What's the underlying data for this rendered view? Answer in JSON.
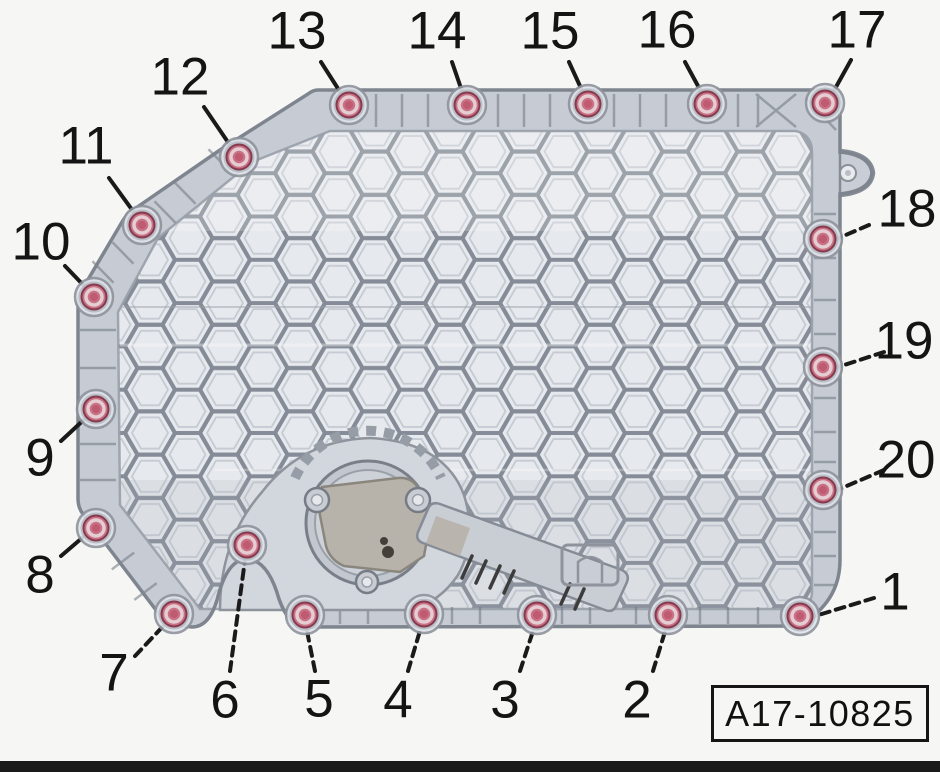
{
  "figure": {
    "code": "A17-10825",
    "colors": {
      "background": "#f6f6f4",
      "pan_base": "#c7ccd4",
      "pan_edge": "#7e858f",
      "mesh_cell": "#e6e9ed",
      "mesh_line": "#858c97",
      "leader_line": "#1a1a1a",
      "label_text": "#141414",
      "bolt_body": "#c97184",
      "bolt_edge": "#87394e",
      "bolt_ring": "#e4cdd3",
      "bolt_center": "#bf5a71",
      "bolt_pocket": "#dfe3e9",
      "bolt_washer": "#b3b8c1"
    },
    "callouts": [
      {
        "n": "1",
        "bolt": [
          800,
          616
        ],
        "label": [
          895,
          592
        ],
        "line": [
          874,
          598,
          812,
          617
        ],
        "dashed": true
      },
      {
        "n": "2",
        "bolt": [
          668,
          615
        ],
        "label": [
          637,
          700
        ],
        "line": [
          653,
          671,
          667,
          625
        ],
        "dashed": true
      },
      {
        "n": "3",
        "bolt": [
          537,
          615
        ],
        "label": [
          505,
          700
        ],
        "line": [
          520,
          671,
          535,
          625
        ],
        "dashed": true
      },
      {
        "n": "4",
        "bolt": [
          424,
          614
        ],
        "label": [
          398,
          700
        ],
        "line": [
          408,
          671,
          422,
          624
        ],
        "dashed": true
      },
      {
        "n": "5",
        "bolt": [
          305,
          615
        ],
        "label": [
          319,
          699
        ],
        "line": [
          315,
          671,
          306,
          626
        ],
        "dashed": true
      },
      {
        "n": "6",
        "bolt": [
          247,
          545
        ],
        "label": [
          225,
          700
        ],
        "line": [
          230,
          671,
          245,
          560
        ],
        "dashed": true
      },
      {
        "n": "7",
        "bolt": [
          174,
          614
        ],
        "label": [
          114,
          673
        ],
        "line": [
          135,
          656,
          168,
          621
        ],
        "dashed": true
      },
      {
        "n": "8",
        "bolt": [
          96,
          528
        ],
        "label": [
          40,
          575
        ],
        "line": [
          61,
          556,
          89,
          532
        ],
        "dashed": false
      },
      {
        "n": "9",
        "bolt": [
          96,
          409
        ],
        "label": [
          40,
          458
        ],
        "line": [
          61,
          441,
          89,
          415
        ],
        "dashed": false
      },
      {
        "n": "10",
        "bolt": [
          94,
          297
        ],
        "label": [
          41,
          242
        ],
        "line": [
          65,
          266,
          89,
          291
        ],
        "dashed": false
      },
      {
        "n": "11",
        "bolt": [
          142,
          225
        ],
        "label": [
          86,
          146
        ],
        "line": [
          109,
          178,
          138,
          218
        ],
        "dashed": false
      },
      {
        "n": "12",
        "bolt": [
          239,
          157
        ],
        "label": [
          180,
          77
        ],
        "line": [
          204,
          107,
          234,
          151
        ],
        "dashed": false
      },
      {
        "n": "13",
        "bolt": [
          349,
          105
        ],
        "label": [
          297,
          31
        ],
        "line": [
          321,
          62,
          344,
          98
        ],
        "dashed": false
      },
      {
        "n": "14",
        "bolt": [
          467,
          105
        ],
        "label": [
          437,
          31
        ],
        "line": [
          452,
          62,
          464,
          97
        ],
        "dashed": false
      },
      {
        "n": "15",
        "bolt": [
          588,
          104
        ],
        "label": [
          550,
          31
        ],
        "line": [
          569,
          62,
          585,
          97
        ],
        "dashed": false
      },
      {
        "n": "16",
        "bolt": [
          707,
          104
        ],
        "label": [
          667,
          30
        ],
        "line": [
          685,
          62,
          704,
          97
        ],
        "dashed": false
      },
      {
        "n": "17",
        "bolt": [
          825,
          103
        ],
        "label": [
          857,
          30
        ],
        "line": [
          851,
          60,
          831,
          96
        ],
        "dashed": false
      },
      {
        "n": "18",
        "bolt": [
          823,
          239
        ],
        "label": [
          907,
          209
        ],
        "line": [
          869,
          225,
          834,
          240
        ],
        "dashed": true
      },
      {
        "n": "19",
        "bolt": [
          823,
          367
        ],
        "label": [
          904,
          341
        ],
        "line": [
          884,
          352,
          835,
          368
        ],
        "dashed": true
      },
      {
        "n": "20",
        "bolt": [
          823,
          490
        ],
        "label": [
          906,
          460
        ],
        "line": [
          884,
          470,
          835,
          491
        ],
        "dashed": true
      }
    ]
  }
}
